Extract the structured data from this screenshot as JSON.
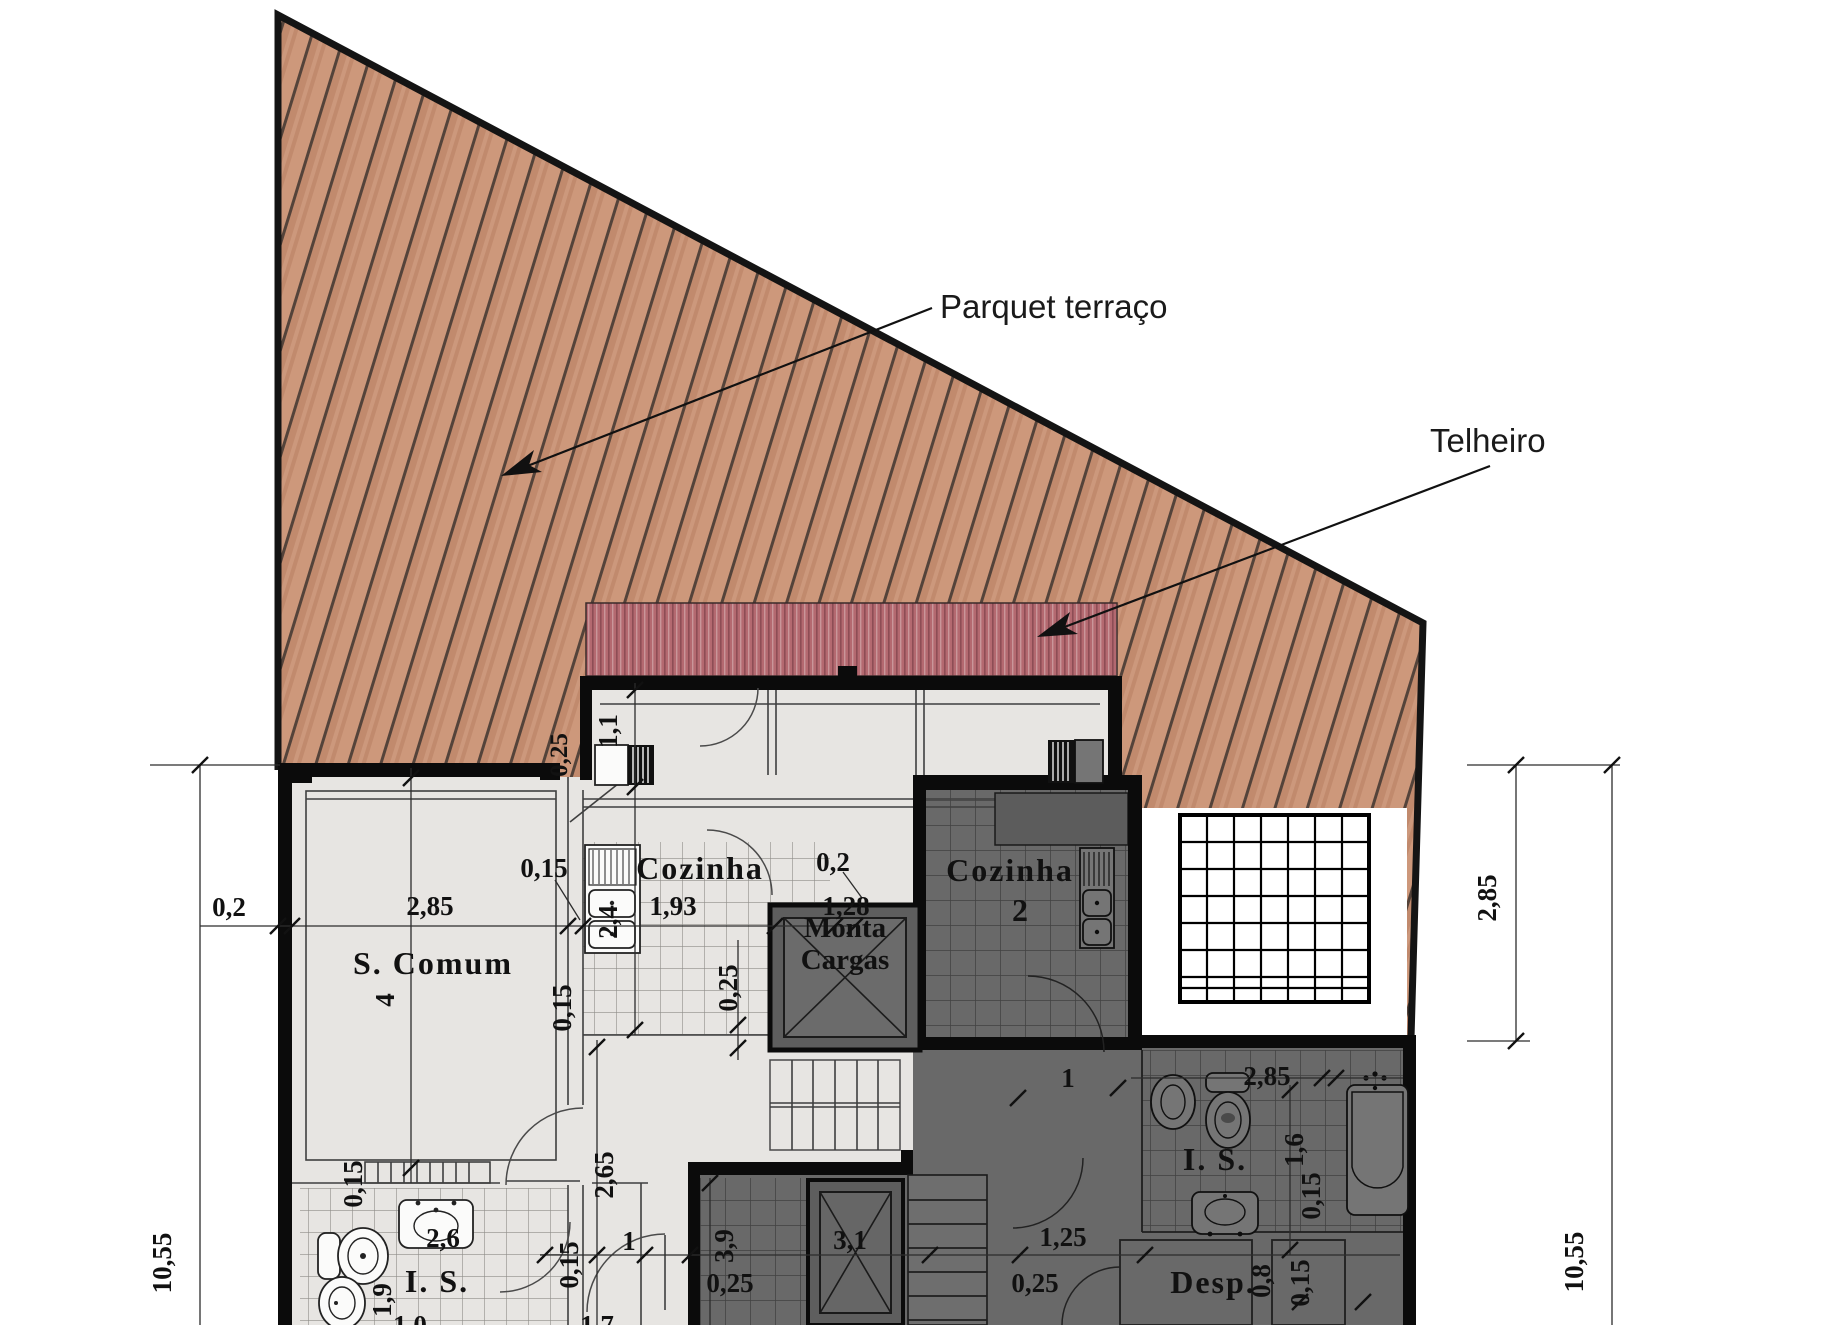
{
  "annotations": {
    "parquet": "Parquet terraço",
    "telheiro": "Telheiro"
  },
  "rooms": {
    "s_comum": "S. Comum",
    "cozinha_left": "Cozinha",
    "cozinha_right": "Cozinha",
    "cozinha_right_number": "2",
    "monta_line1": "Monta",
    "monta_line2": "Cargas",
    "is_left": "I. S.",
    "is_right": "I. S.",
    "desp": "Desp."
  },
  "dimensions": [
    "0,2",
    "2,85",
    "0,15",
    "1,93",
    "0,2",
    "1,28",
    "0,25",
    "1,1",
    "2,4",
    "0,25",
    "0,15",
    "4",
    "0,15",
    "2,6",
    "1,9",
    "2,65",
    "1",
    "0,15",
    "1,0",
    "1,7",
    "3,9",
    "0,25",
    "3,1",
    "1,25",
    "0,25",
    "1",
    "2,85",
    "1,6",
    "0,15",
    "0,8",
    "0,15",
    "10,55",
    "2,85",
    "10,55"
  ],
  "colors": {
    "wood_base": "#cd987b",
    "wood_dark": "#c18a6d",
    "wood_line": "#54433a",
    "roof_red": "#b46970",
    "roof_stripe": "#8d4d55",
    "floor_light": "#e7e5e2",
    "floor_dark": "#696969",
    "wall_black": "#0b0b0b",
    "skylight_white": "#ffffff",
    "brown_label": "#7b4030"
  }
}
